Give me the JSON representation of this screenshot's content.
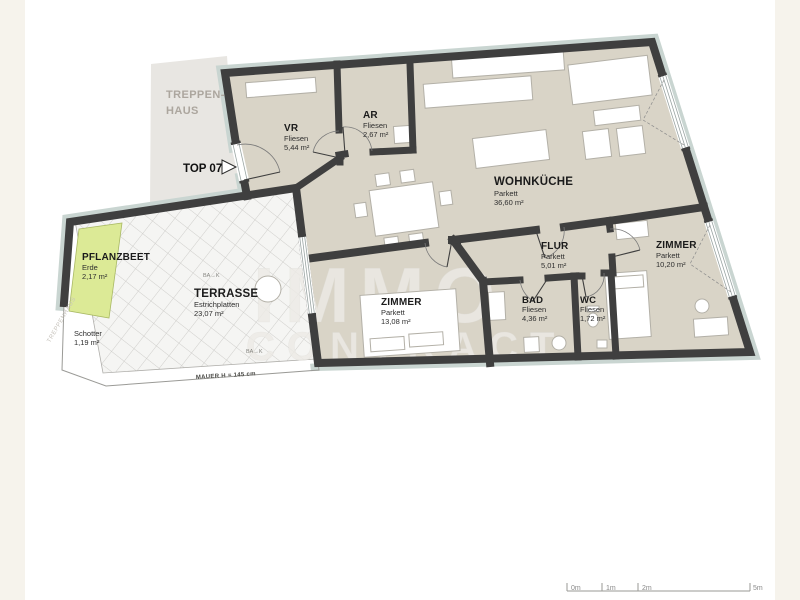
{
  "canvas": {
    "background": "#ffffff",
    "margin_color": "#f6f3ec"
  },
  "colors": {
    "wall": "#3f3f3f",
    "insulation_lining": "#c9d5d1",
    "apartment_floor": "#d9d4c7",
    "terrace_tile": "#f5f5f3",
    "planter_green": "#dcea96",
    "staircase_gray": "#e8e6e2"
  },
  "staircase": {
    "label_line1": "TREPPEN-",
    "label_line2": "HAUS",
    "side_label": "TREPPENHAUS"
  },
  "unit": {
    "label": "TOP 07"
  },
  "rooms": {
    "vr": {
      "name": "VR",
      "material": "Fliesen",
      "area": "5,44 m²"
    },
    "ar": {
      "name": "AR",
      "material": "Fliesen",
      "area": "2,67 m²"
    },
    "wohnkueche": {
      "name": "WOHNKÜCHE",
      "material": "Parkett",
      "area": "36,60 m²"
    },
    "flur": {
      "name": "FLUR",
      "material": "Parkett",
      "area": "5,01 m²"
    },
    "zimmer_klein": {
      "name": "ZIMMER",
      "material": "Parkett",
      "area": "10,20 m²"
    },
    "zimmer_gross": {
      "name": "ZIMMER",
      "material": "Parkett",
      "area": "13,08 m²"
    },
    "bad": {
      "name": "BAD",
      "material": "Fliesen",
      "area": "4,36 m²"
    },
    "wc": {
      "name": "WC",
      "material": "Fliesen",
      "area": "1,72 m²"
    },
    "terrasse": {
      "name": "TERRASSE",
      "material": "Estrichplatten",
      "area": "23,07 m²"
    },
    "pflanzbeet": {
      "name": "PFLANZBEET",
      "material": "Erde",
      "area": "2,17 m²"
    },
    "schotter": {
      "name": "Schotter",
      "area": "1,19 m²"
    }
  },
  "annotations": {
    "wall_height": "MAUER H = 145 cm",
    "floor_drain": "BA→K"
  },
  "watermark": {
    "line1": "IMMO",
    "line2": "CONTRACT"
  },
  "scale_bar": {
    "labels": [
      "0m",
      "1m",
      "2m",
      "5m"
    ]
  }
}
